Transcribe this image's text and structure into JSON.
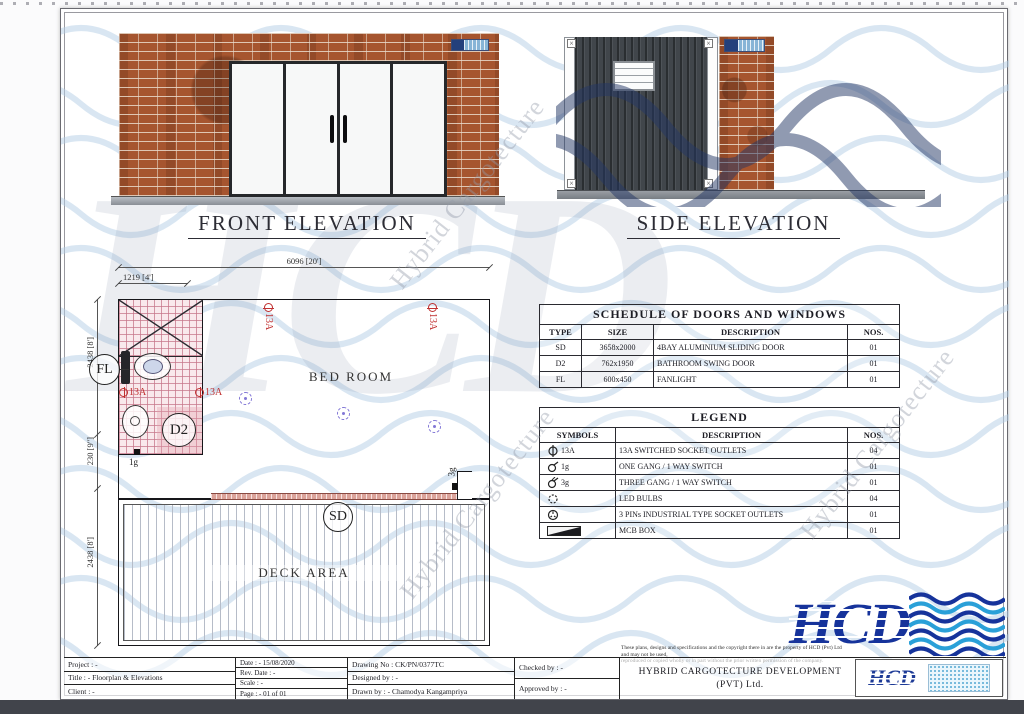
{
  "front": {
    "title": "FRONT ELEVATION"
  },
  "side": {
    "title": "SIDE ELEVATION"
  },
  "plan": {
    "room": "BED ROOM",
    "deck": "DECK AREA",
    "dim_total": "6096 [20']",
    "dim_bath": "1219 [4']",
    "dim_v1": "2438 [8']",
    "dim_v2": "230 [9\"]",
    "dim_v3": "2438 [8']",
    "fl": "FL",
    "d2": "D2",
    "sd": "SD",
    "socket_label": "13A",
    "one_gang": "1g",
    "three_gang": "3g"
  },
  "schedule": {
    "title": "SCHEDULE OF DOORS AND WINDOWS",
    "headers": [
      "TYPE",
      "SIZE",
      "DESCRIPTION",
      "NOS."
    ],
    "rows": [
      {
        "type": "SD",
        "size": "3658x2000",
        "desc": "4BAY ALUMINIUM SLIDING DOOR",
        "nos": "01"
      },
      {
        "type": "D2",
        "size": "762x1950",
        "desc": "BATHROOM SWING DOOR",
        "nos": "01"
      },
      {
        "type": "FL",
        "size": "600x450",
        "desc": "FANLIGHT",
        "nos": "01"
      }
    ]
  },
  "legend": {
    "title": "LEGEND",
    "headers": [
      "SYMBOLS",
      "DESCRIPTION",
      "NOS."
    ],
    "rows": [
      {
        "label": "13A",
        "desc": "13A SWITCHED SOCKET OUTLETS",
        "nos": "04"
      },
      {
        "label": "1g",
        "desc": "ONE GANG / 1 WAY SWITCH",
        "nos": "01"
      },
      {
        "label": "3g",
        "desc": "THREE GANG / 1 WAY SWITCH",
        "nos": "01"
      },
      {
        "label": "",
        "desc": "LED BULBS",
        "nos": "04"
      },
      {
        "label": "",
        "desc": "3 PINs INDUSTRIAL TYPE SOCKET OUTLETS",
        "nos": "01"
      },
      {
        "label": "",
        "desc": "MCB BOX",
        "nos": "01"
      }
    ]
  },
  "title_block": {
    "project": "Project : -",
    "title": "Title : - Floorplan & Elevations",
    "client": "Client : -",
    "date": "Date : - 15/08/2020",
    "rev_date": "Rev. Date : -",
    "scale": "Scale : -",
    "page": "Page : - 01 of 01",
    "drawing_no": "Drawing No : CK/PN/0377TC",
    "designed_by": "Designed by : -",
    "drawn_by": "Drawn by : - Chamodya Kangampriya",
    "checked_by": "Checked by : -",
    "approved_by": "Approved by : -",
    "company_line1": "HYBRID CARGOTECTURE DEVELOPMENT",
    "company_line2": "(PVT) Ltd.",
    "disclaimer_line1": "These plans, designs and specifications and the copyright there in are the property of HCD (Pvt) Ltd and may not be used,",
    "disclaimer_line2": "reproduced or copied wholly or in part without the prior written permission of the company."
  },
  "branding": {
    "logo_text": "HCD",
    "watermark_text": "Hybrid Cargotecture",
    "colors": {
      "logo_blue": "#16339b",
      "wave_light_blue": "#b4cfe6",
      "wave_sky_blue": "#2aa0d8",
      "brick": "#a6552f",
      "container_gray": "#41464b",
      "socket_red": "#c03030",
      "lamp_violet": "#8277d6",
      "bath_pink": "#f9e9ec"
    }
  }
}
